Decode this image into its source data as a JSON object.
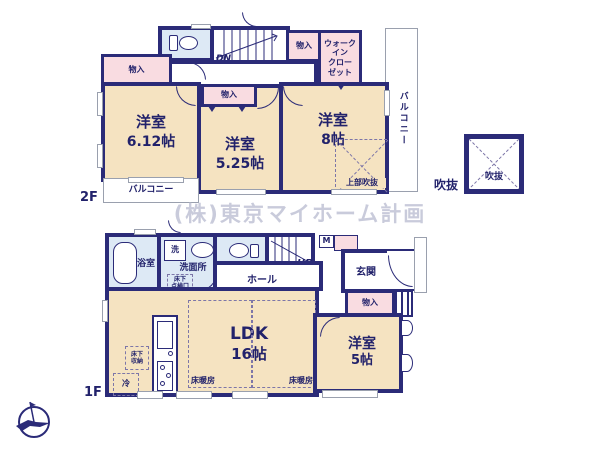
{
  "meta": {
    "watermark": "(株)東京マイホーム計画"
  },
  "floor2": {
    "label": "2F",
    "room_612": {
      "name": "洋室",
      "size": "6.12帖"
    },
    "room_525": {
      "name": "洋室",
      "size": "5.25帖"
    },
    "room_8": {
      "name": "洋室",
      "size": "8帖"
    },
    "closet_left": "物入",
    "closet_mid": "物入",
    "closet_stairs": "物入",
    "wic": "ウォーク\nイン\nクロー\nゼット",
    "stairs": "DN",
    "upper_void": "上部吹抜",
    "balcony_bottom": "バルコニー",
    "balcony_right": "バルコニー"
  },
  "floor1": {
    "label": "1F",
    "ldk": {
      "name": "LDK",
      "size": "16帖"
    },
    "room_5": {
      "name": "洋室",
      "size": "5帖"
    },
    "bath": "浴室",
    "washroom": "洗面所",
    "washer": "洗",
    "underfloor_hatch": "床下\n点検口",
    "hall": "ホール",
    "stairs": "UP",
    "entrance": "玄関",
    "meter": "M",
    "closet": "物入",
    "underfloor_storage": "床下\n収納",
    "fridge": "冷",
    "floorheat_left": "床暖房",
    "floorheat_right": "床暖房"
  },
  "void_box": {
    "outside_label": "吹抜",
    "inside_label": "吹抜"
  },
  "colors": {
    "wall": "#2b2b78",
    "room": "#f5e3c1",
    "closet": "#f9dce1",
    "wet": "#dde9f5",
    "text": "#22226b",
    "gray": "#9aa0ae",
    "wm": "#c9cbdb"
  }
}
